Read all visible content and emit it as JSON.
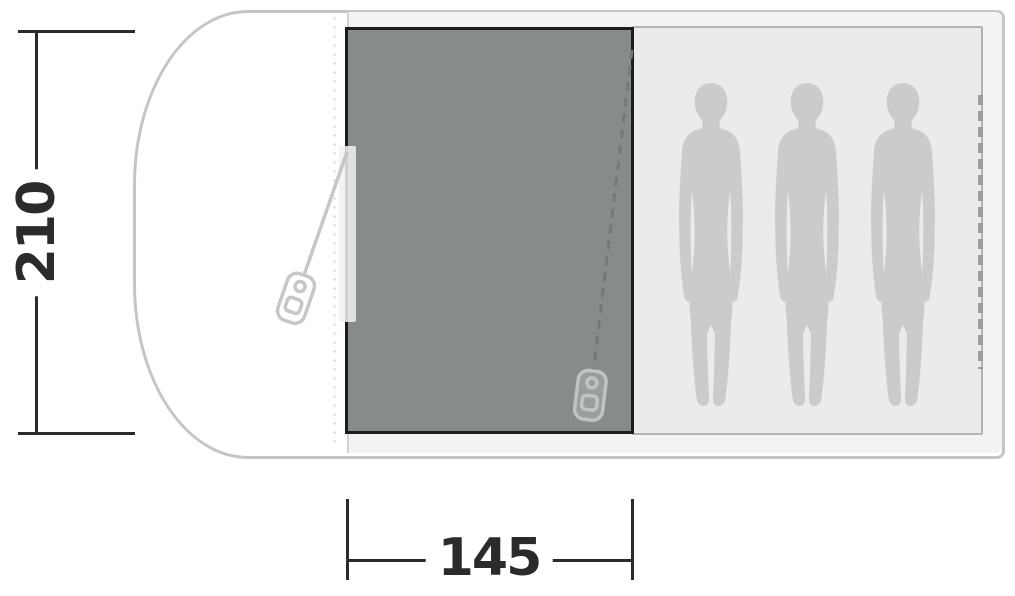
{
  "diagram": {
    "kind": "tent-floorplan",
    "dimensions": {
      "height": {
        "label": "210"
      },
      "width": {
        "label": "145"
      }
    },
    "capacity": {
      "person_count": 3,
      "figure_icon": "person-silhouette"
    },
    "icons": {
      "zipper_pull": "zip-pull-icon",
      "seam": "dotted-seam-line",
      "door": "dashed-zip-door-line"
    },
    "colors": {
      "outline": "#c5c5c5",
      "seam": "#d2d2d2",
      "interior": "#f3f3f4",
      "panel_fill": "#878c8a",
      "panel_border": "#1d1d1d",
      "inner_fill": "#eaebea",
      "inner_border": "#b3b5b4",
      "silhouette": "#c9cccb",
      "dotted": "#d9d2d2",
      "dashed_door": "#9c9e9d",
      "cord_light": "#c6c7c6",
      "cord_dark": "#757976",
      "pull_stroke_light": "#c6c7c6",
      "pull_stroke_dark": "#c1c4c2",
      "strip": "rgba(240,241,240,0.85)",
      "dim": "#2b2b2b"
    }
  }
}
